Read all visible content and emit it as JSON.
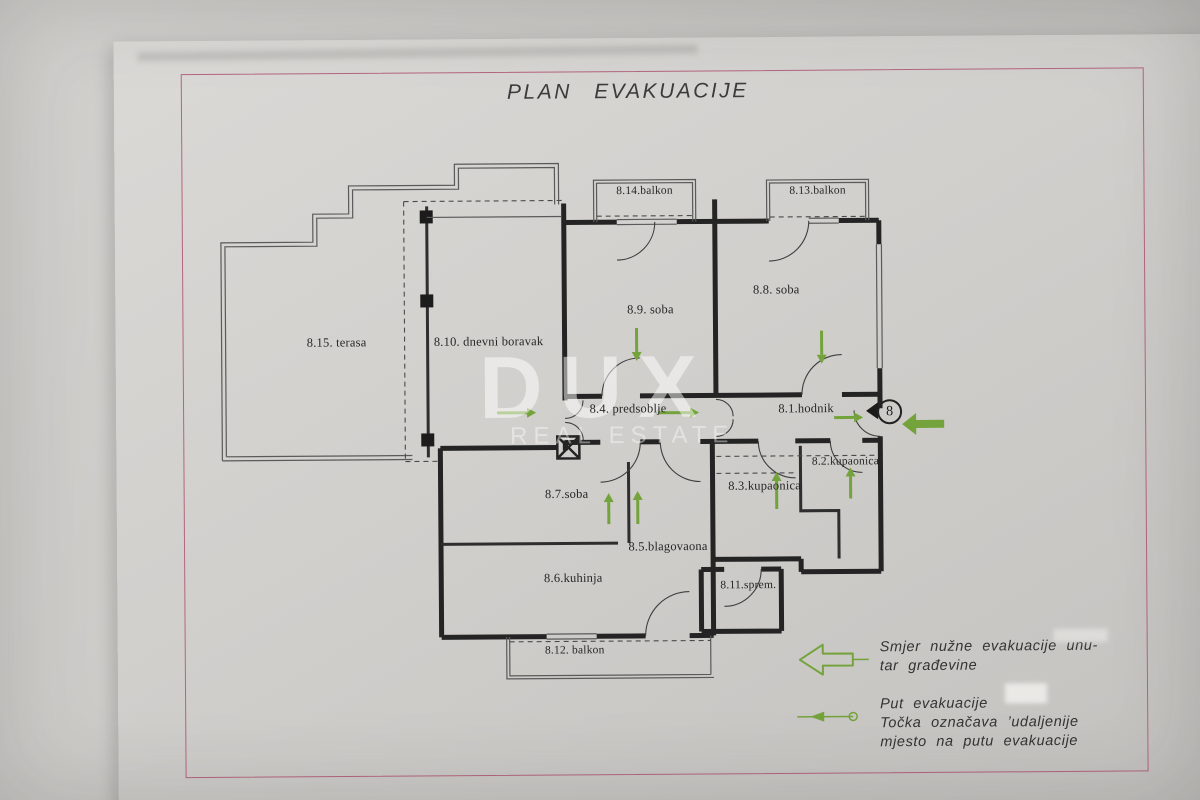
{
  "document": {
    "title": "PLAN EVAKUACIJE"
  },
  "watermark": {
    "line1": "DUX",
    "line2": "REAL ESTATE"
  },
  "evacuation": {
    "exit_point_number": "8"
  },
  "rooms": [
    {
      "id": "8.15",
      "label": "8.15. terasa"
    },
    {
      "id": "8.10",
      "label": "8.10. dnevni boravak"
    },
    {
      "id": "8.14",
      "label": "8.14.balkon"
    },
    {
      "id": "8.13",
      "label": "8.13.balkon"
    },
    {
      "id": "8.9",
      "label": "8.9. soba"
    },
    {
      "id": "8.8",
      "label": "8.8. soba"
    },
    {
      "id": "8.4",
      "label": "8.4. predsoblje"
    },
    {
      "id": "8.1",
      "label": "8.1.hodnik"
    },
    {
      "id": "8.2",
      "label": "8.2.kupaonica"
    },
    {
      "id": "8.3",
      "label": "8.3.kupaonica"
    },
    {
      "id": "8.7",
      "label": "8.7.soba"
    },
    {
      "id": "8.5",
      "label": "8.5.blagovaona"
    },
    {
      "id": "8.6",
      "label": "8.6.kuhinja"
    },
    {
      "id": "8.11",
      "label": "8.11.sprem."
    },
    {
      "id": "8.12",
      "label": "8.12. balkon"
    }
  ],
  "legend": {
    "direction_line1": "Smjer nužne evakuacije unu-",
    "direction_line2": "tar građevine",
    "route_line1": "Put evakuacije",
    "route_line2": "Točka označava   ’udaljenije",
    "route_line3": "mjesto na putu evakuacije"
  },
  "colors": {
    "evacuation_green": "#74a33c",
    "border_pink": "#b4657f",
    "plan_line": "#242424"
  }
}
